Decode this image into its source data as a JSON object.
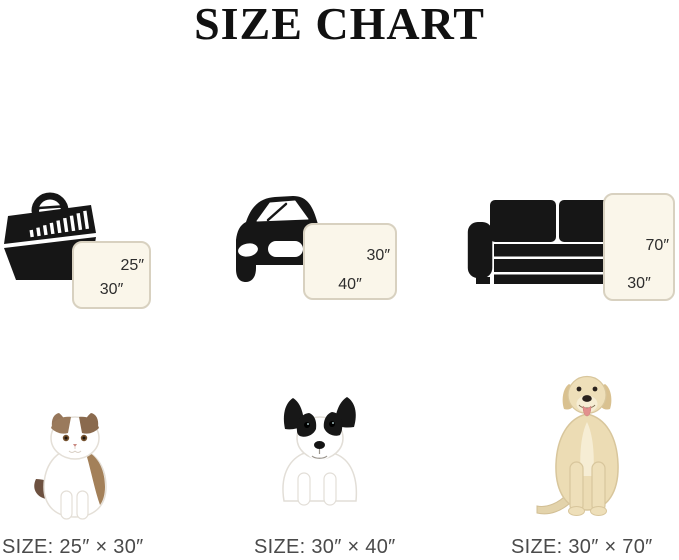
{
  "page": {
    "title": "SIZE CHART"
  },
  "colors": {
    "background": "#ffffff",
    "icon_black": "#161616",
    "pad_fill": "#faf6ea",
    "pad_border": "#d8d1c0",
    "pad_dim_text": "#2d2d2d",
    "size_label_text": "#4a4a4a",
    "title_text": "#111111"
  },
  "columns": [
    {
      "name": "small",
      "icon": "pet-carrier-icon",
      "photo": "exotic-shorthair-cat-photo",
      "pad": {
        "orientation": "landscape",
        "side_label": "25″",
        "bottom_label": "30″"
      },
      "size_label": "SIZE: 25″ × 30″"
    },
    {
      "name": "medium",
      "icon": "car-icon",
      "photo": "french-bulldog-puppy-photo",
      "pad": {
        "orientation": "landscape",
        "side_label": "30″",
        "bottom_label": "40″"
      },
      "size_label": "SIZE: 30″ × 40″"
    },
    {
      "name": "large",
      "icon": "sofa-icon",
      "photo": "labrador-retriever-photo",
      "pad": {
        "orientation": "portrait",
        "side_label": "70″",
        "bottom_label": "30″"
      },
      "size_label": "SIZE: 30″ × 70″"
    }
  ]
}
